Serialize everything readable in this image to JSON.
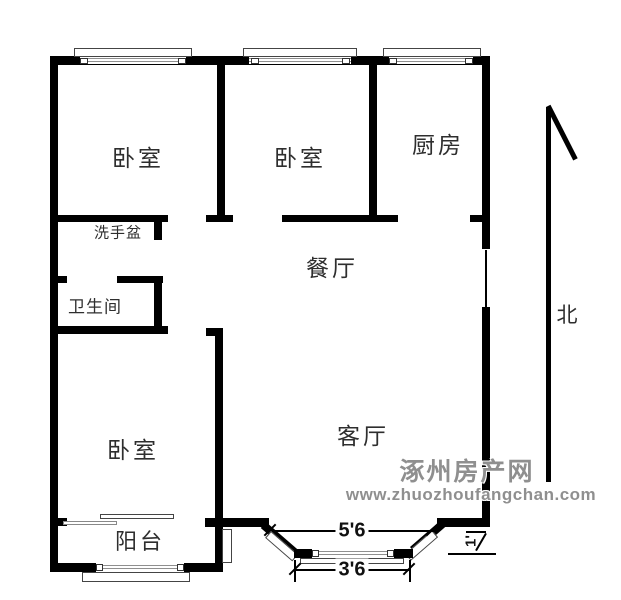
{
  "rooms": {
    "bedroom_top_left": "卧室",
    "bedroom_top_middle": "卧室",
    "kitchen": "厨房",
    "dining_room": "餐厅",
    "washbasin": "洗手盆",
    "bathroom": "卫生间",
    "bedroom_bottom": "卧室",
    "balcony": "阳台",
    "living_room": "客厅"
  },
  "compass": {
    "north": "北"
  },
  "dimensions": {
    "bay_window_outer_width": "5'6",
    "bay_window_inner_width": "3'6",
    "wall_offset": "1'"
  },
  "watermark": {
    "site_name": "涿州房产网",
    "site_url": "www.zhuozhoufangchan.com"
  },
  "colors": {
    "wall": "#000000",
    "background": "#ffffff",
    "window_glazing": "#8f8f8f",
    "room_label": "#2e2e2e",
    "watermark": "#8f8f8f"
  }
}
